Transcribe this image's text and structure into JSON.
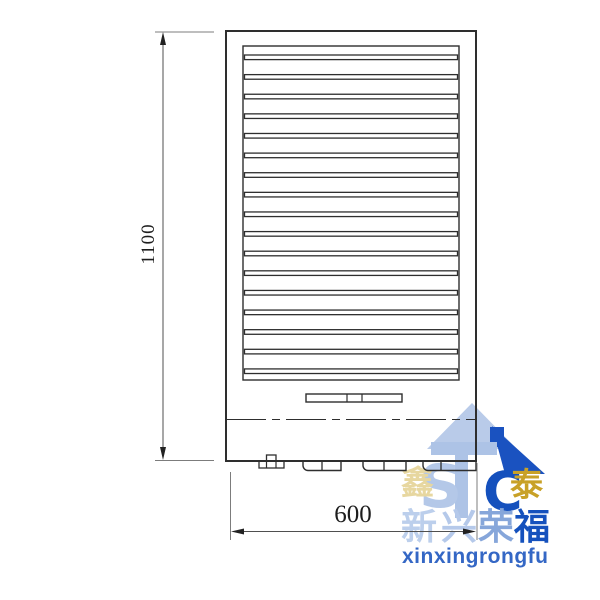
{
  "drawing": {
    "type": "technical-front-elevation",
    "line_color": "#2e2e2e",
    "dim_line_color": "#4f4f4f",
    "louver": {
      "slat_count": 17,
      "first_slat_top": 55,
      "slat_spacing": 19.62,
      "slat_height": 4.6,
      "slat_x": 244.5,
      "slat_width": 213
    },
    "dimensions": {
      "height_label": "1100",
      "width_label": "600"
    }
  },
  "watermark": {
    "monogram": {
      "s": "S",
      "c": "C"
    },
    "char_left": "鑫",
    "char_right": "泰",
    "brand_chars": [
      "新",
      "兴",
      "荣",
      "福"
    ],
    "brand_latin": "xinxingrongfu",
    "colors": {
      "light_blue": "#b9cbe9",
      "mid_blue": "#86a6da",
      "dark_blue": "#1a52c0",
      "latin_blue": "#3467c5",
      "gold": "#c8a127",
      "pale_gold": "#e7d7a0"
    }
  }
}
